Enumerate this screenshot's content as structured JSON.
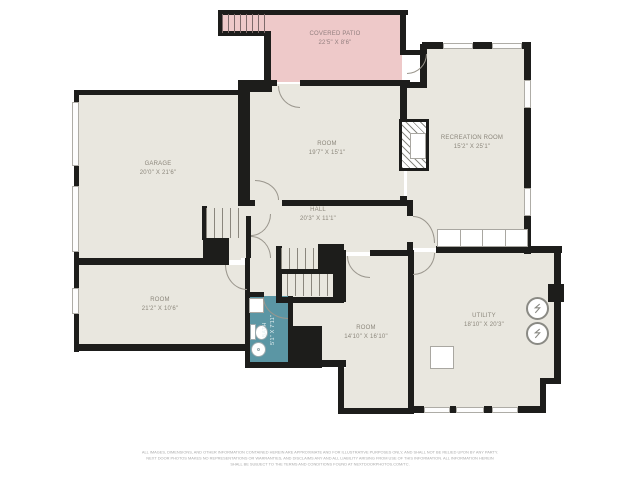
{
  "title": "FLOOR PLAN",
  "colors": {
    "floor": "#e9e7df",
    "wall": "#1d1d1b",
    "patio": "#eec9c9",
    "bath": "#5b96a4",
    "label_text": "#8c877c"
  },
  "rooms": {
    "covered_patio": {
      "name": "COVERED PATIO",
      "dims": "22'5\" X 8'6\""
    },
    "garage": {
      "name": "GARAGE",
      "dims": "20'0\" X 21'6\""
    },
    "room_center": {
      "name": "ROOM",
      "dims": "19'7\" X 15'1\""
    },
    "recreation_room": {
      "name": "RECREATION ROOM",
      "dims": "15'2\" X 25'1\""
    },
    "hall": {
      "name": "HALL",
      "dims": "20'3\" X 11'1\""
    },
    "room_left": {
      "name": "ROOM",
      "dims": "21'2\" X 10'6\""
    },
    "bath": {
      "name": "BATH",
      "dims": "5'1\" X 7'11\""
    },
    "room_bottom": {
      "name": "ROOM",
      "dims": "14'10\" X 16'10\""
    },
    "utility": {
      "name": "UTILITY",
      "dims": "18'10\" X 20'3\""
    }
  },
  "disclaimer": {
    "line1": "ALL IMAGES, DIMENSIONS, AND OTHER INFORMATION CONTAINED HEREIN ARE APPROXIMATE AND FOR ILLUSTRATIVE PURPOSES ONLY, AND SHALL NOT BE RELIED UPON BY ANY PARTY.",
    "line2": "NEXT DOOR PHOTOS MAKES NO REPRESENTATIONS OR WARRANTIES, AND DISCLAIMS ANY AND ALL LIABILITY ARISING FROM USE OF THIS INFORMATION. ALL INFORMATION HEREIN",
    "line3": "SHALL BE SUBJECT TO THE TERMS AND CONDITIONS FOUND AT NEXTDOORPHOTOS.COM/TC."
  }
}
